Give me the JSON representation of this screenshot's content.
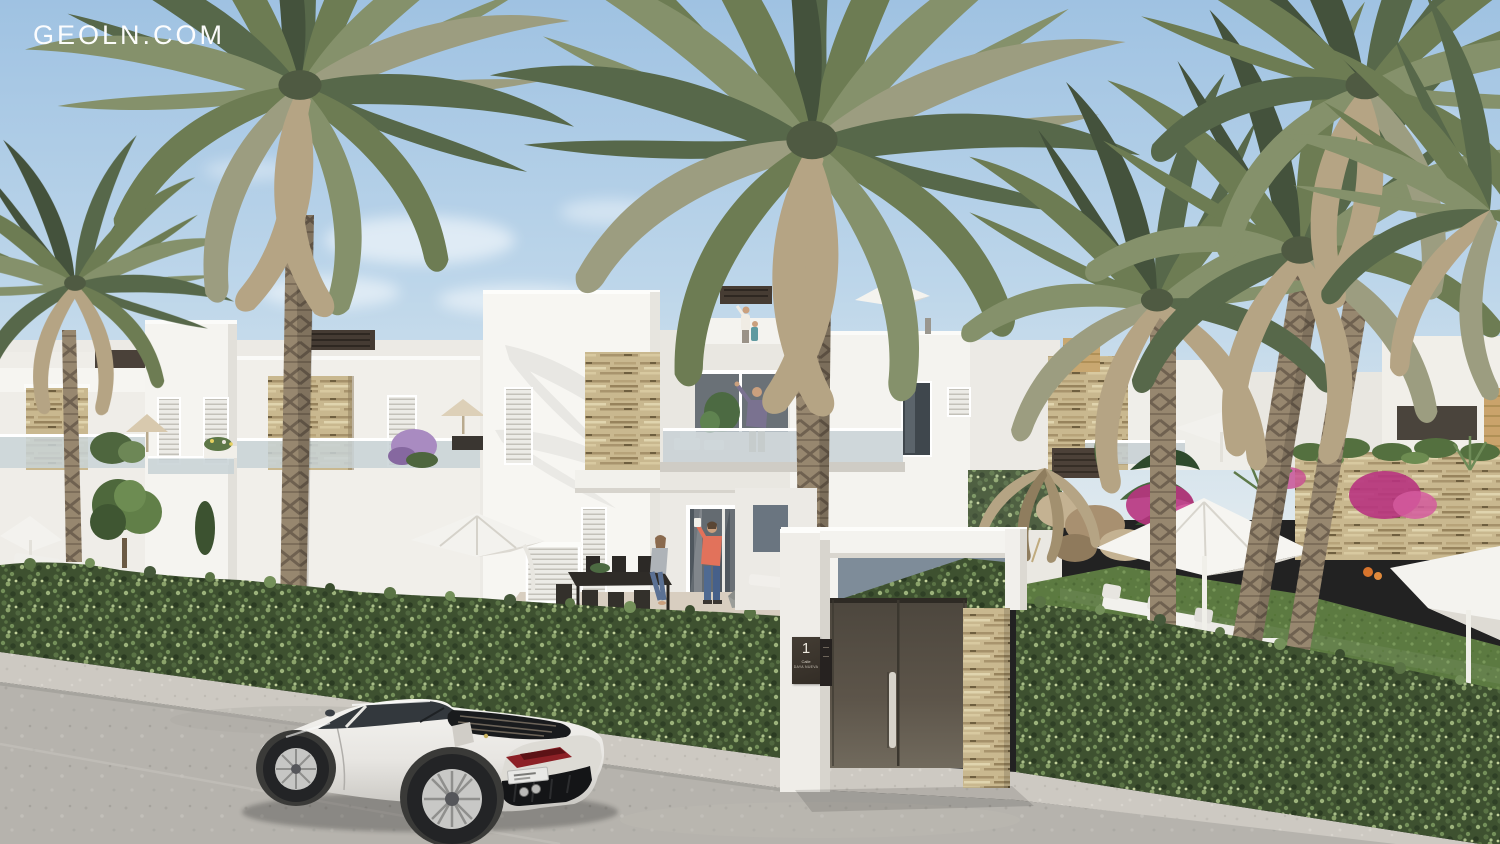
{
  "watermark": {
    "text": "GEOLN.COM",
    "color": "#ffffff"
  },
  "gate": {
    "plaque": {
      "number": "1",
      "street_label": "Calle",
      "street_name": "DAYA NUEVA",
      "bg_color": "#3a342c",
      "text_color": "#eee9df"
    },
    "door_color": "#5d554a",
    "left_pillar": "white rendered pillar",
    "right_pillar": "beige stacked-stone pedestal",
    "handle": "vertical steel pull bar"
  },
  "scene": {
    "setting": "Sunny render of new-build white Mediterranean townhouses behind a clipped privacy hedge, tall palm trees, entrance gate and a white sports coupe parked on the street",
    "objects": [
      "palm-trees",
      "white-townhouses",
      "roof-terraces",
      "glass-balustrades",
      "stone-clad-accent-panels",
      "louvered-shutters",
      "privacy-hedge",
      "entrance-gate",
      "garden-lawn",
      "sun-umbrellas",
      "sun-loungers",
      "outdoor-dining-set",
      "white-sports-car",
      "street",
      "sidewalk",
      "bougainvillea",
      "rockery"
    ],
    "people": [
      {
        "where": "ground-floor terrace",
        "desc": "woman seated on dining table edge"
      },
      {
        "where": "ground-floor terrace",
        "desc": "man in coral shirt taking a photo"
      },
      {
        "where": "first-floor balcony",
        "desc": "man with both arms raised"
      },
      {
        "where": "roof terrace",
        "desc": "woman and child waving"
      }
    ],
    "car": {
      "type": "sports coupe",
      "color": "white",
      "view": "rear three-quarter, facing left",
      "plate": "illegible"
    },
    "palette": {
      "sky_top": "#9fc2e2",
      "sky_horizon": "#dfe9ee",
      "building_white": "#f6f5f1",
      "building_shade": "#e4e2dc",
      "stone": "#c9b88f",
      "hedge": "#3e5130",
      "lawn": "#5c7a41",
      "road": "#b6b3ad",
      "sidewalk": "#cdc9c2",
      "door": "#5d554a",
      "palm_green": "#6d7c53",
      "palm_dry": "#b5a484",
      "trunk": "#97876f"
    }
  }
}
